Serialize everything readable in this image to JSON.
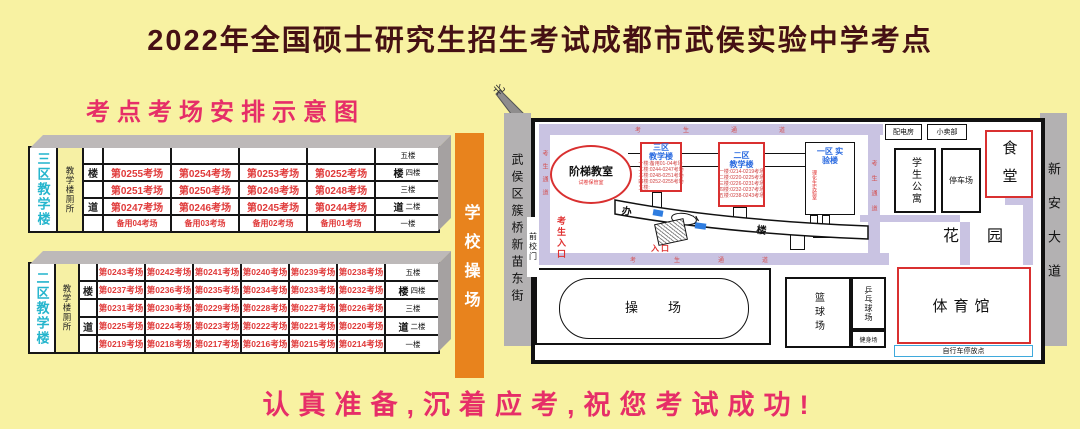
{
  "page": {
    "title": "2022年全国硕士研究生招生考试成都市武侯实验中学考点",
    "subtitle": "考点考场安排示意图",
    "slogan": "认真准备,沉着应考,祝您考试成功!"
  },
  "colors": {
    "accent_pink": "#e62e68",
    "accent_red": "#d93030",
    "cyan_label": "#25b5cd",
    "blue_label": "#2a6ae0",
    "playground_orange": "#e8831d",
    "road_purple": "#c9c3e2"
  },
  "playground_bar": {
    "label": "学校操场"
  },
  "tables": {
    "zone3": {
      "building_label": "三区教学楼",
      "toilet_label": "教学楼厕所",
      "rows": [
        {
          "stair": "",
          "floor": "五楼",
          "cells": [
            "",
            "",
            "",
            ""
          ]
        },
        {
          "stair": "楼",
          "floor": "四楼",
          "cells": [
            "第0255考场",
            "第0254考场",
            "第0253考场",
            "第0252考场"
          ]
        },
        {
          "stair": "",
          "floor": "三楼",
          "cells": [
            "第0251考场",
            "第0250考场",
            "第0249考场",
            "第0248考场"
          ]
        },
        {
          "stair": "道",
          "floor": "二楼",
          "cells": [
            "第0247考场",
            "第0246考场",
            "第0245考场",
            "第0244考场"
          ]
        },
        {
          "stair": "",
          "floor": "一楼",
          "cells": [
            "备用04考场",
            "备用03考场",
            "备用02考场",
            "备用01考场"
          ]
        }
      ]
    },
    "zone2": {
      "building_label": "二区教学楼",
      "toilet_label": "教学楼厕所",
      "rows": [
        {
          "stair": "",
          "floor": "五楼",
          "cells": [
            "第0243考场",
            "第0242考场",
            "第0241考场",
            "第0240考场",
            "第0239考场",
            "第0238考场"
          ]
        },
        {
          "stair": "楼",
          "floor": "四楼",
          "cells": [
            "第0237考场",
            "第0236考场",
            "第0235考场",
            "第0234考场",
            "第0233考场",
            "第0232考场"
          ]
        },
        {
          "stair": "",
          "floor": "三楼",
          "cells": [
            "第0231考场",
            "第0230考场",
            "第0229考场",
            "第0228考场",
            "第0227考场",
            "第0226考场"
          ]
        },
        {
          "stair": "道",
          "floor": "二楼",
          "cells": [
            "第0225考场",
            "第0224考场",
            "第0223考场",
            "第0222考场",
            "第0221考场",
            "第0220考场"
          ]
        },
        {
          "stair": "",
          "floor": "一楼",
          "cells": [
            "第0219考场",
            "第0218考场",
            "第0217考场",
            "第0216考场",
            "第0215考场",
            "第0214考场"
          ]
        }
      ]
    }
  },
  "map": {
    "streets": {
      "left": "武侯区簇桥新苗东街",
      "right": "新安大道"
    },
    "compass": "北",
    "gate": "前校门",
    "examinee_entrance": "考生入口",
    "path_label": "考生通道",
    "lecture_hall": {
      "name": "阶梯教室",
      "note": "试卷保管室"
    },
    "zone3": {
      "name": "三区 教学楼",
      "floors": [
        "一楼:备用01-04考场",
        "二楼:0244-0247考场",
        "三楼:0248-0251考场",
        "四楼:0252-0255考场",
        "五楼:"
      ]
    },
    "zone2": {
      "name": "二区 教学楼",
      "floors": [
        "一楼:0214-0219考场",
        "二楼:0220-0225考场",
        "三楼:0226-0231考场",
        "四楼:0232-0237考场",
        "五楼:0238-0243考场"
      ]
    },
    "zone1": {
      "name": "一区 实验楼",
      "note": "理化生实验室"
    },
    "office": "办公楼",
    "entrance": "入口",
    "power_room": "配电房",
    "shop": "小卖部",
    "canteen": "食堂",
    "dorm": "学生公寓",
    "parking": "停车场",
    "garden": "花园",
    "track": "操场",
    "basketball": "篮球场",
    "pingpong": "乒乓球场",
    "fitness": "健身场",
    "gym": "体育馆",
    "bike_parking": "自行车停放点"
  }
}
